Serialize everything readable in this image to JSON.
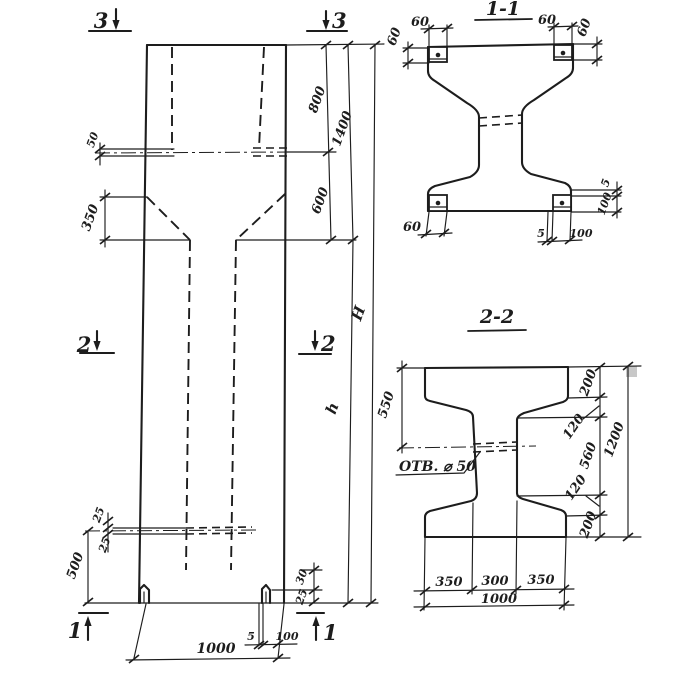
{
  "colors": {
    "ink": "#1d1d1d",
    "paper": "#ffffff",
    "artifact": "#c8c8c8"
  },
  "section_markers": {
    "m1": "1",
    "m2": "2",
    "m3": "3"
  },
  "elevation": {
    "dims": {
      "plate_gap_50": "50",
      "taper_350": "350",
      "seg_800": "800",
      "seg_600": "600",
      "total_1400": "1400",
      "height_H": "H",
      "height_h": "h",
      "plate_25_upper": "25",
      "plate_25_lower": "25",
      "foot_500": "500",
      "foot_30": "30",
      "foot_25": "25",
      "base_5": "5",
      "base_100": "100",
      "width_1000": "1000"
    }
  },
  "section_1_1": {
    "title": "1-1",
    "dims": {
      "top_left_60": "60",
      "top_right_60": "60",
      "left_60": "60",
      "right_60": "60",
      "bottom_left_60": "60",
      "bottom_5": "5",
      "bottom_100": "100",
      "right_5": "5",
      "right_100": "100"
    }
  },
  "section_2_2": {
    "title": "2-2",
    "hole_label": "ОТВ. ⌀ 50",
    "dims": {
      "left_550": "550",
      "right_200_top": "200",
      "right_120_top": "120",
      "right_560": "560",
      "right_120_bottom": "120",
      "right_200_bottom": "200",
      "right_1200": "1200",
      "bottom_350_left": "350",
      "bottom_300": "300",
      "bottom_350_right": "350",
      "bottom_1000": "1000"
    }
  }
}
